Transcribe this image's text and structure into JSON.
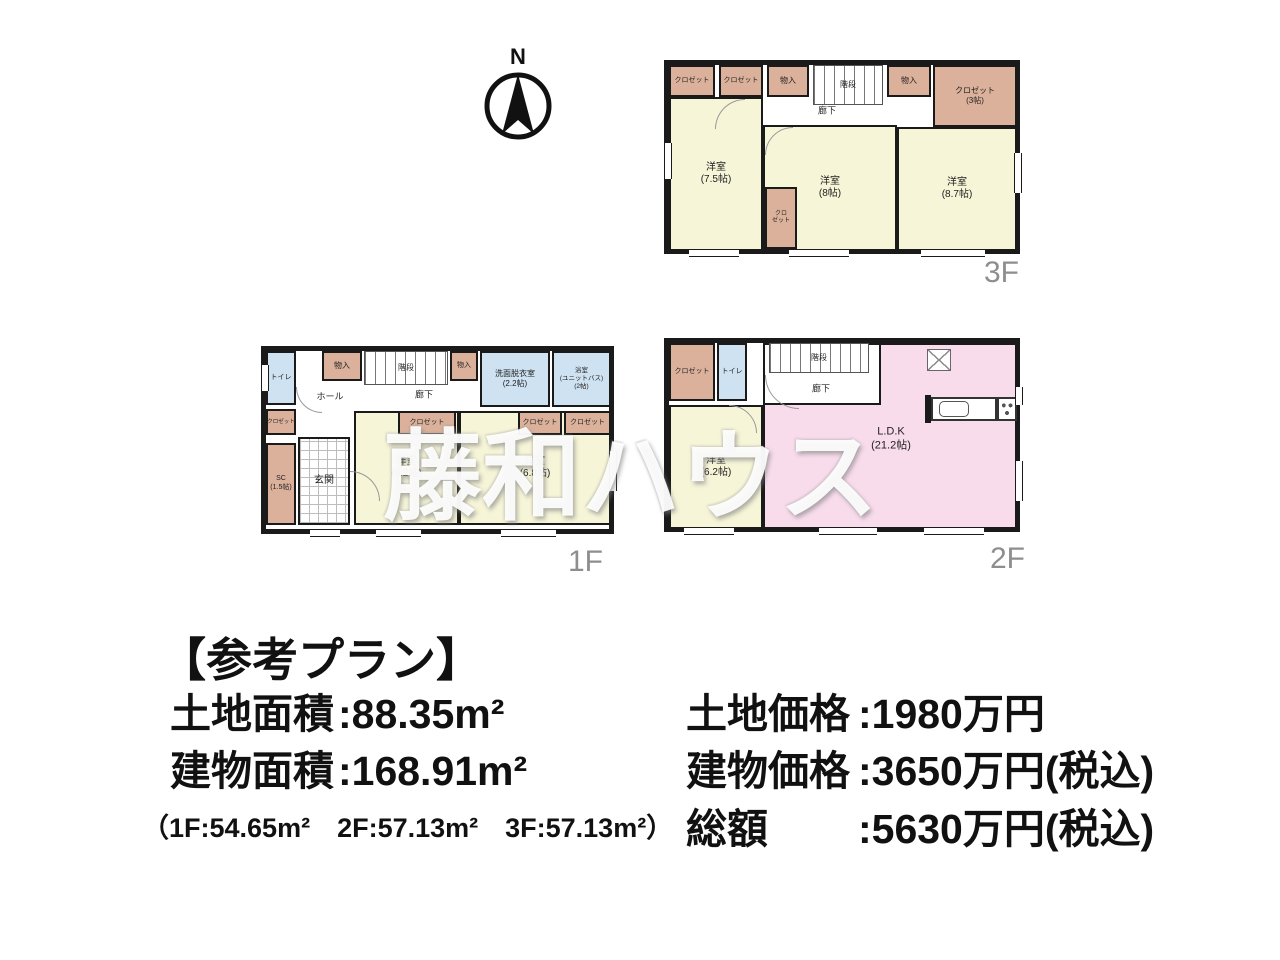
{
  "colors": {
    "wall": "#1a1a1a",
    "room": "#f6f5d8",
    "closet": "#dcb19b",
    "water": "#cfe2f1",
    "ldk": "#f8dcec",
    "floorLabel": "#8e8e8e"
  },
  "compass": {
    "label": "N"
  },
  "watermark": {
    "text": "藤和ハウス"
  },
  "floors": [
    {
      "id": "3f",
      "label": "3F",
      "frame": {
        "x": 664,
        "y": 60,
        "w": 356,
        "h": 194
      },
      "label_pos": {
        "x": 984,
        "y": 256
      },
      "rooms": [
        {
          "name": "closet",
          "type": "closet",
          "x": 0,
          "y": 0,
          "w": 46,
          "h": 32,
          "label": [
            "クロゼット"
          ],
          "fs": 7
        },
        {
          "name": "closet",
          "type": "closet",
          "x": 50,
          "y": 0,
          "w": 44,
          "h": 32,
          "label": [
            "クロゼット"
          ],
          "fs": 7
        },
        {
          "name": "storage",
          "type": "closet",
          "x": 98,
          "y": 0,
          "w": 42,
          "h": 32,
          "label": [
            "物入"
          ],
          "fs": 8
        },
        {
          "name": "staircase",
          "type": "stairs",
          "x": 144,
          "y": 0,
          "w": 70,
          "h": 40,
          "label": [
            "階段"
          ],
          "fs": 8
        },
        {
          "name": "storage",
          "type": "closet",
          "x": 218,
          "y": 0,
          "w": 44,
          "h": 32,
          "label": [
            "物入"
          ],
          "fs": 8
        },
        {
          "name": "closet",
          "type": "closet",
          "x": 264,
          "y": 0,
          "w": 84,
          "h": 62,
          "label": [
            "クロゼット",
            "(3帖)"
          ],
          "fs": 8
        },
        {
          "name": "western-room",
          "type": "room",
          "x": 0,
          "y": 32,
          "w": 94,
          "h": 154,
          "label": [
            "洋室",
            "(7.5帖)"
          ],
          "fs": 10
        },
        {
          "name": "western-room",
          "type": "room",
          "x": 94,
          "y": 60,
          "w": 134,
          "h": 126,
          "label": [
            "洋室",
            "(8帖)"
          ],
          "fs": 10
        },
        {
          "name": "western-room",
          "type": "room",
          "x": 228,
          "y": 62,
          "w": 120,
          "h": 124,
          "label": [
            "洋室",
            "(8.7帖)"
          ],
          "fs": 10
        },
        {
          "name": "closet",
          "type": "closet",
          "x": 96,
          "y": 122,
          "w": 32,
          "h": 62,
          "label": [
            "クロ",
            "ゼット"
          ],
          "fs": 6
        }
      ],
      "labels": [
        {
          "name": "hallway-label",
          "x": 158,
          "y": 46,
          "lines": [
            "廊下"
          ],
          "fs": 9
        }
      ],
      "openings": [
        {
          "x": 20,
          "y": 184,
          "w": 50,
          "h": 8,
          "dir": "h"
        },
        {
          "x": 120,
          "y": 184,
          "w": 60,
          "h": 8,
          "dir": "h"
        },
        {
          "x": 252,
          "y": 184,
          "w": 64,
          "h": 8,
          "dir": "h"
        },
        {
          "x": -5,
          "y": 78,
          "w": 8,
          "h": 36,
          "dir": "v"
        },
        {
          "x": 345,
          "y": 88,
          "w": 8,
          "h": 40,
          "dir": "v"
        }
      ],
      "arcs": [
        {
          "x": 46,
          "y": 34,
          "s": 30,
          "c": "tl"
        },
        {
          "x": 96,
          "y": 62,
          "s": 28,
          "c": "tl"
        }
      ]
    },
    {
      "id": "1f",
      "label": "1F",
      "frame": {
        "x": 261,
        "y": 346,
        "w": 353,
        "h": 188
      },
      "label_pos": {
        "x": 568,
        "y": 545
      },
      "rooms": [
        {
          "name": "toilet",
          "type": "water",
          "x": 0,
          "y": 0,
          "w": 30,
          "h": 54,
          "label": [
            "トイレ"
          ],
          "fs": 7
        },
        {
          "name": "storage",
          "type": "closet",
          "x": 56,
          "y": 0,
          "w": 40,
          "h": 30,
          "label": [
            "物入"
          ],
          "fs": 8
        },
        {
          "name": "staircase",
          "type": "stairs",
          "x": 98,
          "y": 0,
          "w": 84,
          "h": 34,
          "label": [
            "階段"
          ],
          "fs": 8
        },
        {
          "name": "storage",
          "type": "closet",
          "x": 184,
          "y": 0,
          "w": 28,
          "h": 30,
          "label": [
            "物入"
          ],
          "fs": 7
        },
        {
          "name": "washroom",
          "type": "water",
          "x": 214,
          "y": 0,
          "w": 70,
          "h": 56,
          "label": [
            "洗面脱衣室",
            "(2.2帖)"
          ],
          "fs": 8
        },
        {
          "name": "bathroom",
          "type": "water",
          "x": 286,
          "y": 0,
          "w": 59,
          "h": 56,
          "label": [
            "浴室",
            "(ユニットバス)",
            "(2帖)"
          ],
          "fs": 6.5
        },
        {
          "name": "closet",
          "type": "closet",
          "x": 0,
          "y": 58,
          "w": 30,
          "h": 26,
          "label": [
            "クロゼット"
          ],
          "fs": 5.5
        },
        {
          "name": "shoe-closet",
          "type": "closet",
          "x": 0,
          "y": 92,
          "w": 30,
          "h": 82,
          "label": [
            "SC",
            "(1.5帖)"
          ],
          "fs": 7
        },
        {
          "name": "entrance",
          "type": "tile",
          "x": 32,
          "y": 86,
          "w": 52,
          "h": 88,
          "label": [
            "玄関"
          ],
          "fs": 10
        },
        {
          "name": "western-room",
          "type": "room",
          "x": 88,
          "y": 60,
          "w": 105,
          "h": 114,
          "label": [
            "洋室",
            "(6.2帖)"
          ],
          "fs": 10
        },
        {
          "name": "closet",
          "type": "closet",
          "x": 132,
          "y": 60,
          "w": 58,
          "h": 24,
          "label": [
            "クロゼット"
          ],
          "fs": 7
        },
        {
          "name": "western-room",
          "type": "room",
          "x": 193,
          "y": 60,
          "w": 152,
          "h": 114,
          "label": [
            "洋室",
            "(6.8帖)"
          ],
          "fs": 10
        },
        {
          "name": "closet",
          "type": "closet",
          "x": 252,
          "y": 60,
          "w": 44,
          "h": 24,
          "label": [
            "クロゼット"
          ],
          "fs": 7
        },
        {
          "name": "closet",
          "type": "closet",
          "x": 298,
          "y": 60,
          "w": 47,
          "h": 24,
          "label": [
            "クロゼット"
          ],
          "fs": 7
        }
      ],
      "labels": [
        {
          "name": "hall-label",
          "x": 64,
          "y": 46,
          "lines": [
            "ホール"
          ],
          "fs": 9
        },
        {
          "name": "hallway-label",
          "x": 158,
          "y": 44,
          "lines": [
            "廊下"
          ],
          "fs": 9
        }
      ],
      "openings": [
        {
          "x": 110,
          "y": 178,
          "w": 45,
          "h": 8,
          "dir": "h"
        },
        {
          "x": 235,
          "y": 178,
          "w": 55,
          "h": 8,
          "dir": "h"
        },
        {
          "x": 44,
          "y": 178,
          "w": 30,
          "h": 8,
          "dir": "h"
        },
        {
          "x": 343,
          "y": 100,
          "w": 8,
          "h": 40,
          "dir": "v"
        },
        {
          "x": -5,
          "y": 14,
          "w": 8,
          "h": 26,
          "dir": "v"
        }
      ],
      "arcs": [
        {
          "x": 84,
          "y": 120,
          "s": 30,
          "c": "tr"
        },
        {
          "x": 30,
          "y": 36,
          "s": 26,
          "c": "bl"
        }
      ]
    },
    {
      "id": "2f",
      "label": "2F",
      "frame": {
        "x": 664,
        "y": 338,
        "w": 356,
        "h": 194
      },
      "label_pos": {
        "x": 990,
        "y": 542
      },
      "rooms": [
        {
          "name": "ldk",
          "type": "ldk",
          "x": 94,
          "y": 0,
          "w": 254,
          "h": 186
        },
        {
          "name": "hallway",
          "type": "plain",
          "x": 94,
          "y": 0,
          "w": 118,
          "h": 62
        },
        {
          "name": "staircase",
          "type": "stairs",
          "x": 100,
          "y": 0,
          "w": 100,
          "h": 30,
          "label": [
            "階段"
          ],
          "fs": 8
        },
        {
          "name": "closet",
          "type": "closet",
          "x": 0,
          "y": 0,
          "w": 46,
          "h": 58,
          "label": [
            "クロゼット"
          ],
          "fs": 7
        },
        {
          "name": "toilet",
          "type": "water",
          "x": 48,
          "y": 0,
          "w": 30,
          "h": 58,
          "label": [
            "トイレ"
          ],
          "fs": 7
        },
        {
          "name": "western-room",
          "type": "room",
          "x": 0,
          "y": 62,
          "w": 94,
          "h": 124,
          "label": [
            "洋室",
            "(6.2帖)"
          ],
          "fs": 10
        },
        {
          "name": "kitchen-wall",
          "type": "wallstub",
          "x": 256,
          "y": 52,
          "w": 6,
          "h": 28
        },
        {
          "name": "kitchen-counter",
          "type": "counter",
          "x": 262,
          "y": 54,
          "w": 66,
          "h": 24
        },
        {
          "name": "kitchen-sink",
          "type": "sink",
          "x": 270,
          "y": 58,
          "w": 30,
          "h": 16
        },
        {
          "name": "stove",
          "type": "stove",
          "x": 328,
          "y": 54,
          "w": 20,
          "h": 24
        },
        {
          "name": "pantry-box",
          "type": "xbox",
          "x": 258,
          "y": 6,
          "w": 24,
          "h": 22
        }
      ],
      "labels": [
        {
          "name": "hallway-label",
          "x": 152,
          "y": 46,
          "lines": [
            "廊下"
          ],
          "fs": 9
        },
        {
          "name": "ldk-label",
          "x": 222,
          "y": 96,
          "lines": [
            "L.D.K",
            "(21.2帖)"
          ],
          "fs": 11
        }
      ],
      "openings": [
        {
          "x": 15,
          "y": 184,
          "w": 50,
          "h": 8,
          "dir": "h"
        },
        {
          "x": 150,
          "y": 184,
          "w": 58,
          "h": 8,
          "dir": "h"
        },
        {
          "x": 255,
          "y": 184,
          "w": 60,
          "h": 8,
          "dir": "h"
        },
        {
          "x": 346,
          "y": 44,
          "w": 8,
          "h": 18,
          "dir": "v"
        },
        {
          "x": 346,
          "y": 118,
          "w": 8,
          "h": 40,
          "dir": "v"
        }
      ],
      "arcs": [
        {
          "x": 96,
          "y": 32,
          "s": 34,
          "c": "bl"
        },
        {
          "x": 60,
          "y": 62,
          "s": 28,
          "c": "tr"
        }
      ]
    }
  ],
  "info": {
    "title": "【参考プラン】",
    "left": [
      {
        "label": "土地面積",
        "value": ":88.35m²"
      },
      {
        "label": "建物面積",
        "value": ":168.91m²"
      }
    ],
    "left_sub": "（1F:54.65m²　2F:57.13m²　3F:57.13m²）",
    "right": [
      {
        "label": "土地価格",
        "value": ":1980万円"
      },
      {
        "label": "建物価格",
        "value": ":3650万円(税込)"
      },
      {
        "label": "総額",
        "value": ":5630万円(税込)"
      }
    ]
  }
}
